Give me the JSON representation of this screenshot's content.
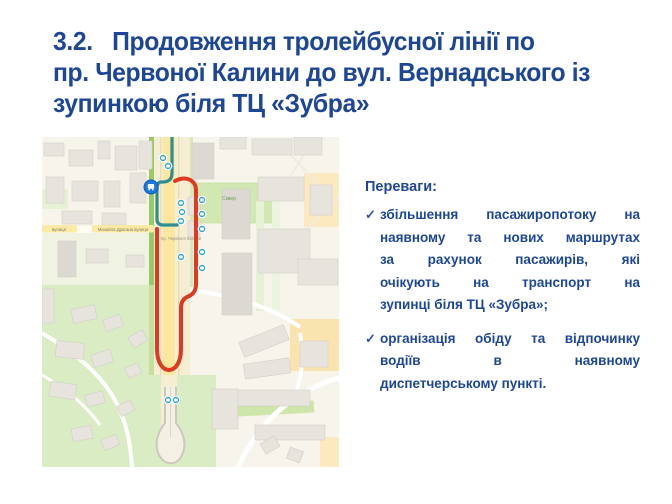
{
  "slide": {
    "title_lines": [
      "3.2.   Продовження тролейбусної лінії по",
      "пр. Червоної Калини до вул. Вернадського із",
      "зупинкою біля ТЦ «Зубра»"
    ],
    "accent_blue": "#1d4796"
  },
  "advantages": {
    "heading": "Переваги:",
    "check_glyph": "✓",
    "items": [
      {
        "lines": [
          "збільшення пасажиропотоку на",
          "наявному та нових маршрутах",
          "за рахунок пасажирів, які",
          "очікують на транспорт на",
          "зупинці біля ТЦ «Зубра»;"
        ]
      },
      {
        "lines": [
          "організація обіду та відпочинку",
          "водіїв в наявному",
          "диспетчерському пункті."
        ]
      }
    ]
  },
  "map": {
    "street_label_left": "вулиця",
    "street_label_main": "Михайла Драгана вулиця",
    "road_label": "пр. Червоної Калини",
    "park_label": "Сквер",
    "marker_icon": "bus-icon",
    "colors": {
      "route_new": "#dc3b22",
      "route_existing": "#2f8e93",
      "stop": "#38a8cc",
      "terminal_marker": "#1b79dd"
    }
  }
}
